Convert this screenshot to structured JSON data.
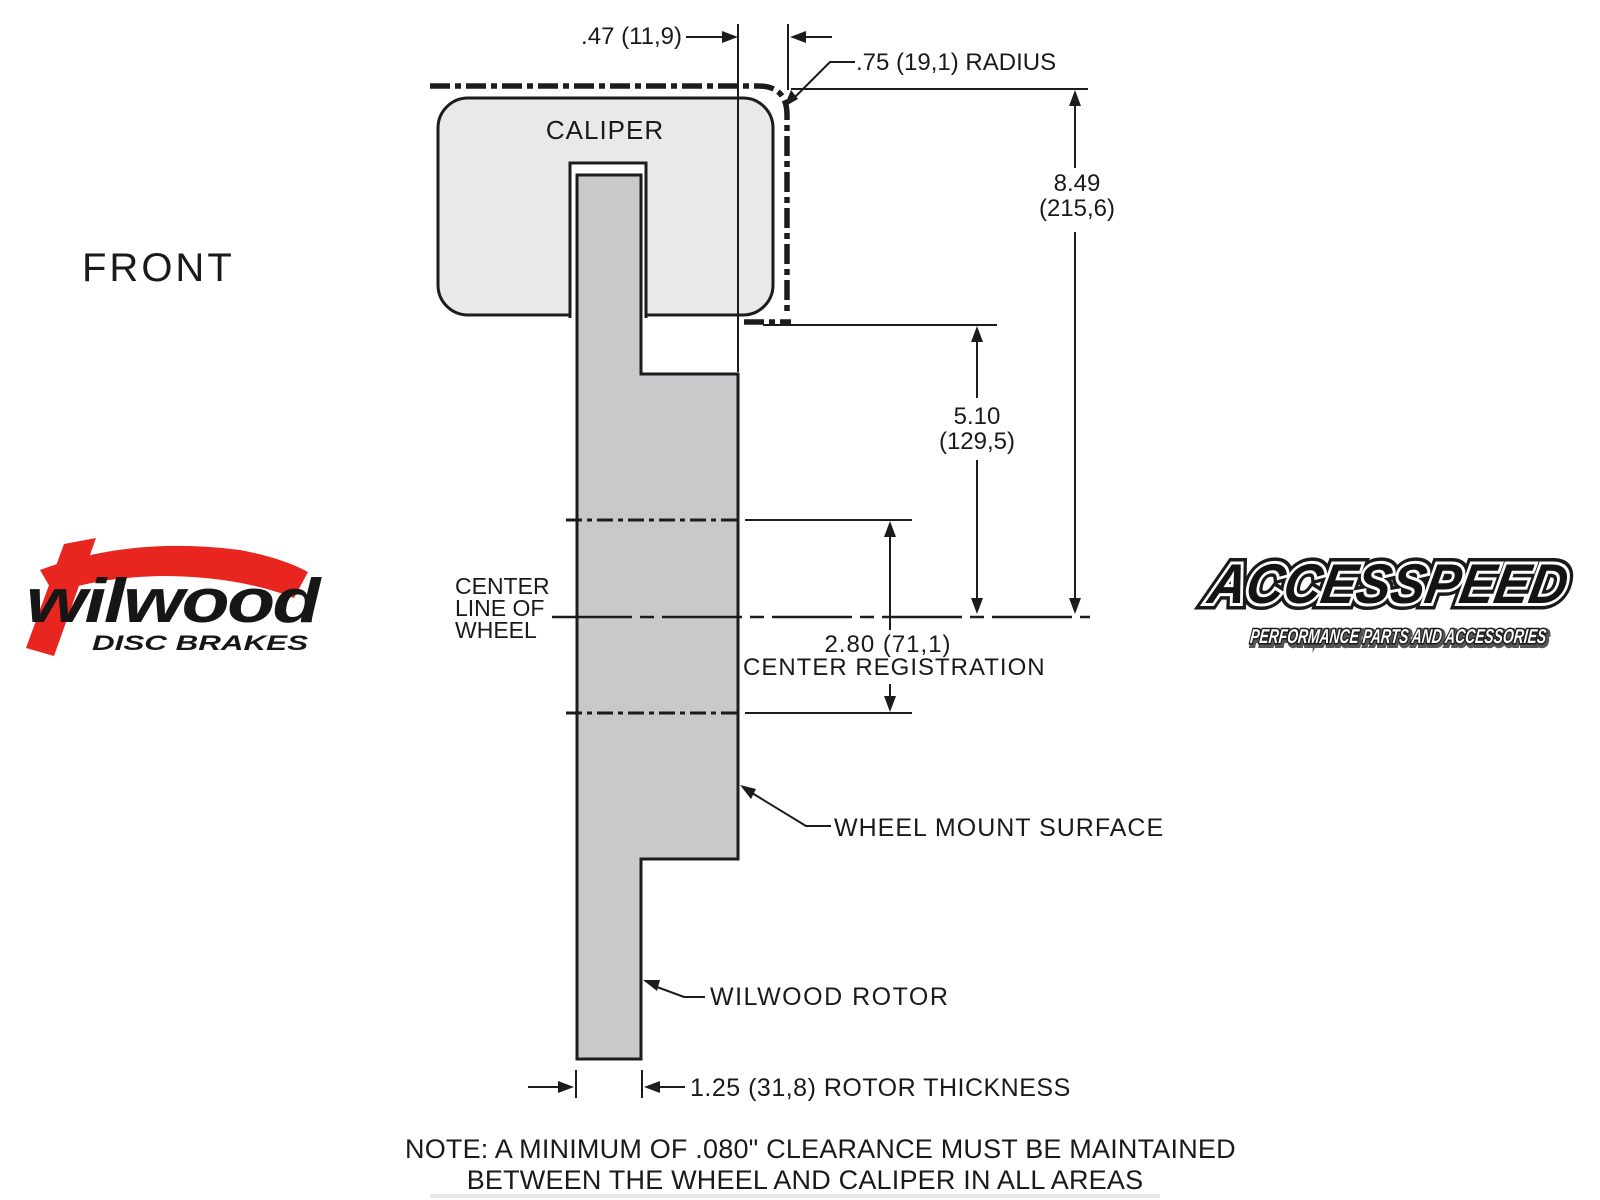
{
  "colors": {
    "line": "#1c1c1c",
    "caliper_fill": "#e9e9e9",
    "rotor_fill": "#c9c9cc",
    "brand_red": "#e8251f"
  },
  "labels": {
    "front": "FRONT",
    "caliper": "CALIPER",
    "center_line": {
      "l1": "CENTER",
      "l2": "LINE OF",
      "l3": "WHEEL"
    },
    "wheel_mount_surface": "WHEEL MOUNT SURFACE",
    "wilwood_rotor": "WILWOOD ROTOR"
  },
  "dimensions": {
    "offset_top": ".47 (11,9)",
    "radius": ".75 (19,1) RADIUS",
    "overall_height_in": "8.49",
    "overall_height_mm": "(215,6)",
    "caliper_to_center_in": "5.10",
    "caliper_to_center_mm": "(129,5)",
    "center_registration_value": "2.80 (71,1)",
    "center_registration_label": "CENTER REGISTRATION",
    "rotor_thickness": "1.25 (31,8) ROTOR THICKNESS"
  },
  "note": {
    "line1": "NOTE: A MINIMUM OF .080\" CLEARANCE MUST BE MAINTAINED",
    "line2": "BETWEEN THE WHEEL AND CALIPER IN ALL AREAS"
  },
  "logos": {
    "wilwood": {
      "name": "wilwood",
      "tagline": "DISC BRAKES"
    },
    "accesspeed": {
      "name": "ACCESSPEED",
      "tagline": "PERFORMANCE PARTS AND ACCESSORIES"
    }
  }
}
